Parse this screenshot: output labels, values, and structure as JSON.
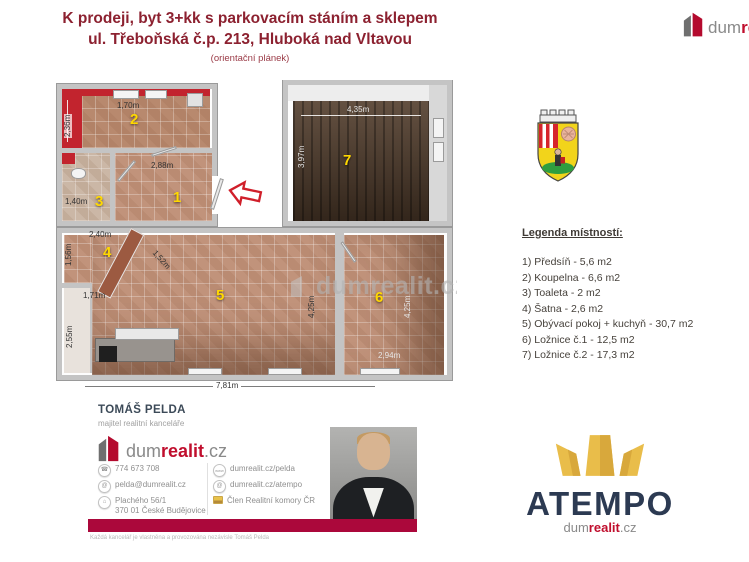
{
  "header": {
    "title_line1": "K prodeji, byt 3+kk s parkovacím stáním a sklepem",
    "title_line2": "ul. Třeboňská č.p. 213, Hluboká nad Vltavou",
    "subtitle": "(orientační plánek)"
  },
  "brand": {
    "dum": "dum",
    "realit": "realit",
    "cz": ".cz",
    "re_partial": "re"
  },
  "icons": {
    "phone": "☎",
    "email": "@",
    "location": "⌂",
    "web": "www",
    "web2": "@"
  },
  "floorplan": {
    "watermark": "dumrealit.cz",
    "rooms": {
      "r1": "1",
      "r2": "2",
      "r3": "3",
      "r4": "4",
      "r5": "5",
      "r6": "6",
      "r7": "7"
    },
    "dims": {
      "room2_height": "2,36m",
      "room2_width": "1,70m",
      "room1_width": "2,88m",
      "room3_width": "1,40m",
      "room7_width": "4,35m",
      "room7_height": "3,97m",
      "room4_width": "2,40m",
      "room4_height": "1,56m",
      "room5_left2": "1,71m",
      "room5_left": "2,55m",
      "room5_diag": "1,52m",
      "room5_height": "4,25m",
      "room5_width": "7,81m",
      "room6_height": "4,25m",
      "room6_width": "2,94m"
    }
  },
  "legend": {
    "title": "Legenda místností:",
    "items": [
      "1) Předsíň - 5,6 m2",
      "2) Koupelna - 6,6 m2",
      "3) Toaleta - 2 m2",
      "4) Šatna - 2,6 m2",
      "5) Obývací pokoj + kuchyň - 30,7 m2",
      "6) Ložnice č.1 - 12,5 m2",
      "7) Ložnice č.2 - 17,3 m2"
    ]
  },
  "agent": {
    "name": "TOMÁŠ PELDA",
    "role": "majitel realitní kanceláře",
    "phone": "774 673 708",
    "email": "pelda@dumrealit.cz",
    "address_line1": "Plachého 56/1",
    "address_line2": "370 01 České Budějovice",
    "web_profile": "dumrealit.cz/pelda",
    "web_office": "dumrealit.cz/atempo",
    "membership": "Člen Realitní komory ČR",
    "disclaimer": "Každá kancelář je vlastněna a provozována nezávisle Tomáš Pelda"
  },
  "atempo": {
    "name": "ATEMPO"
  }
}
